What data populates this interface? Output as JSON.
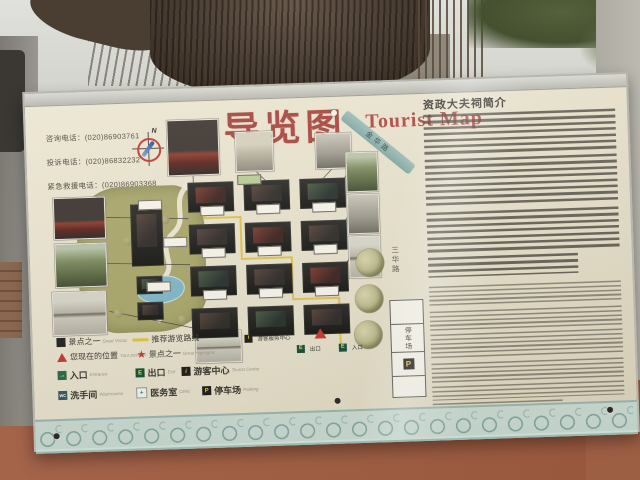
{
  "sign": {
    "title": {
      "zh": "导览图",
      "en": "Tourist Map"
    },
    "contacts": {
      "consult": "咨询电话：(020)86903761",
      "complaint": "投诉电话：(020)86832232",
      "emergency": "紧急救援电话：(020)86903368"
    },
    "intro": {
      "title": "资政大夫祠简介"
    },
    "map": {
      "compass_n": "N",
      "road_jinhua": "金华路",
      "road_sanhua": "三华路",
      "parking_lot": "停车场",
      "parking_symbol": "P",
      "visitor_center": "游客服务中心",
      "visitor_center_glyph": "i",
      "exit": "出口",
      "exit_glyph": "E",
      "entrance": "入口",
      "entrance_glyph": "E"
    },
    "legend": {
      "items": [
        {
          "glyph": "",
          "zh": "景点之一",
          "en": "Great Vistas"
        },
        {
          "glyph": "",
          "zh": "推荐游览路线",
          "en": ""
        },
        {
          "glyph": "",
          "zh": "您现在的位置",
          "en": "Your position"
        },
        {
          "glyph": "★",
          "zh": "景点之一",
          "en": "Great Highlights"
        },
        {
          "glyph": "→",
          "zh": "入口",
          "en": "Entrance"
        },
        {
          "glyph": "E",
          "zh": "出口",
          "en": "Exit"
        },
        {
          "glyph": "i",
          "zh": "游客中心",
          "en": "Tourist Center"
        },
        {
          "glyph": "WC",
          "zh": "洗手间",
          "en": "Washrooms"
        },
        {
          "glyph": "+",
          "zh": "医务室",
          "en": "Clinic"
        },
        {
          "glyph": "P",
          "zh": "停车场",
          "en": "Parking"
        }
      ]
    },
    "colors": {
      "accent_red": "#a6413b",
      "parking_yellow": "#e9c832"
    }
  }
}
